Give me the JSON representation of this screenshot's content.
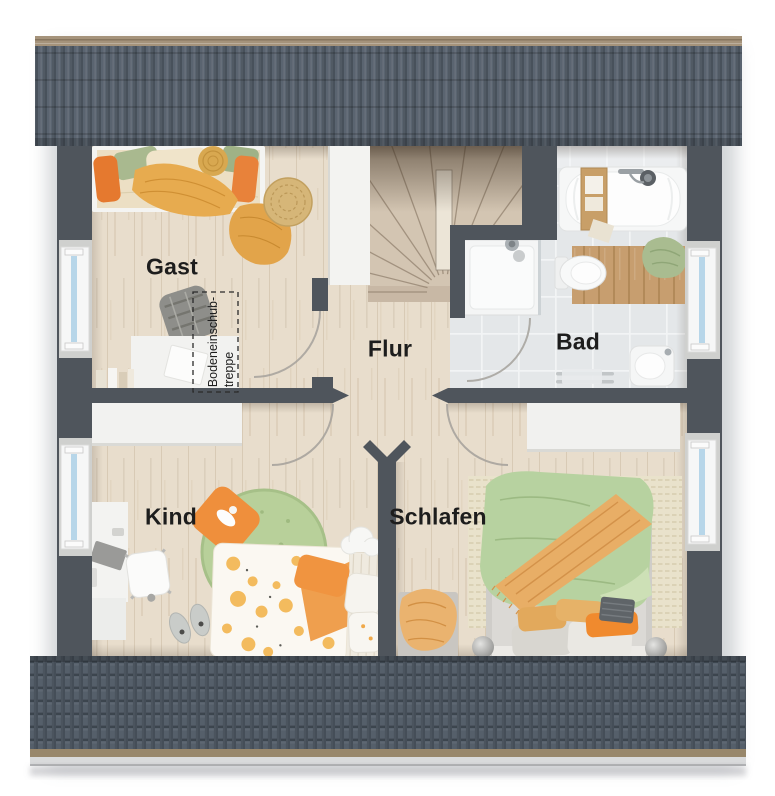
{
  "rooms": {
    "gast": "Gast",
    "flur": "Flur",
    "bad": "Bad",
    "kind": "Kind",
    "schlafen": "Schlafen"
  },
  "annotations": {
    "attic_stairs_line1": "Bodeneinschub-",
    "attic_stairs_line2": "treppe"
  },
  "palette": {
    "roof": "#5a6470",
    "roof_ridge": "#a5937b",
    "wall": "#4f555c",
    "wood_floor": "#e8ddcc",
    "tile_floor": "#e4e7e9",
    "window_glass": "#b7d6e9",
    "accent_orange": "#ef9440",
    "accent_green": "#aac28f",
    "label_text": "#1d1d1d"
  }
}
